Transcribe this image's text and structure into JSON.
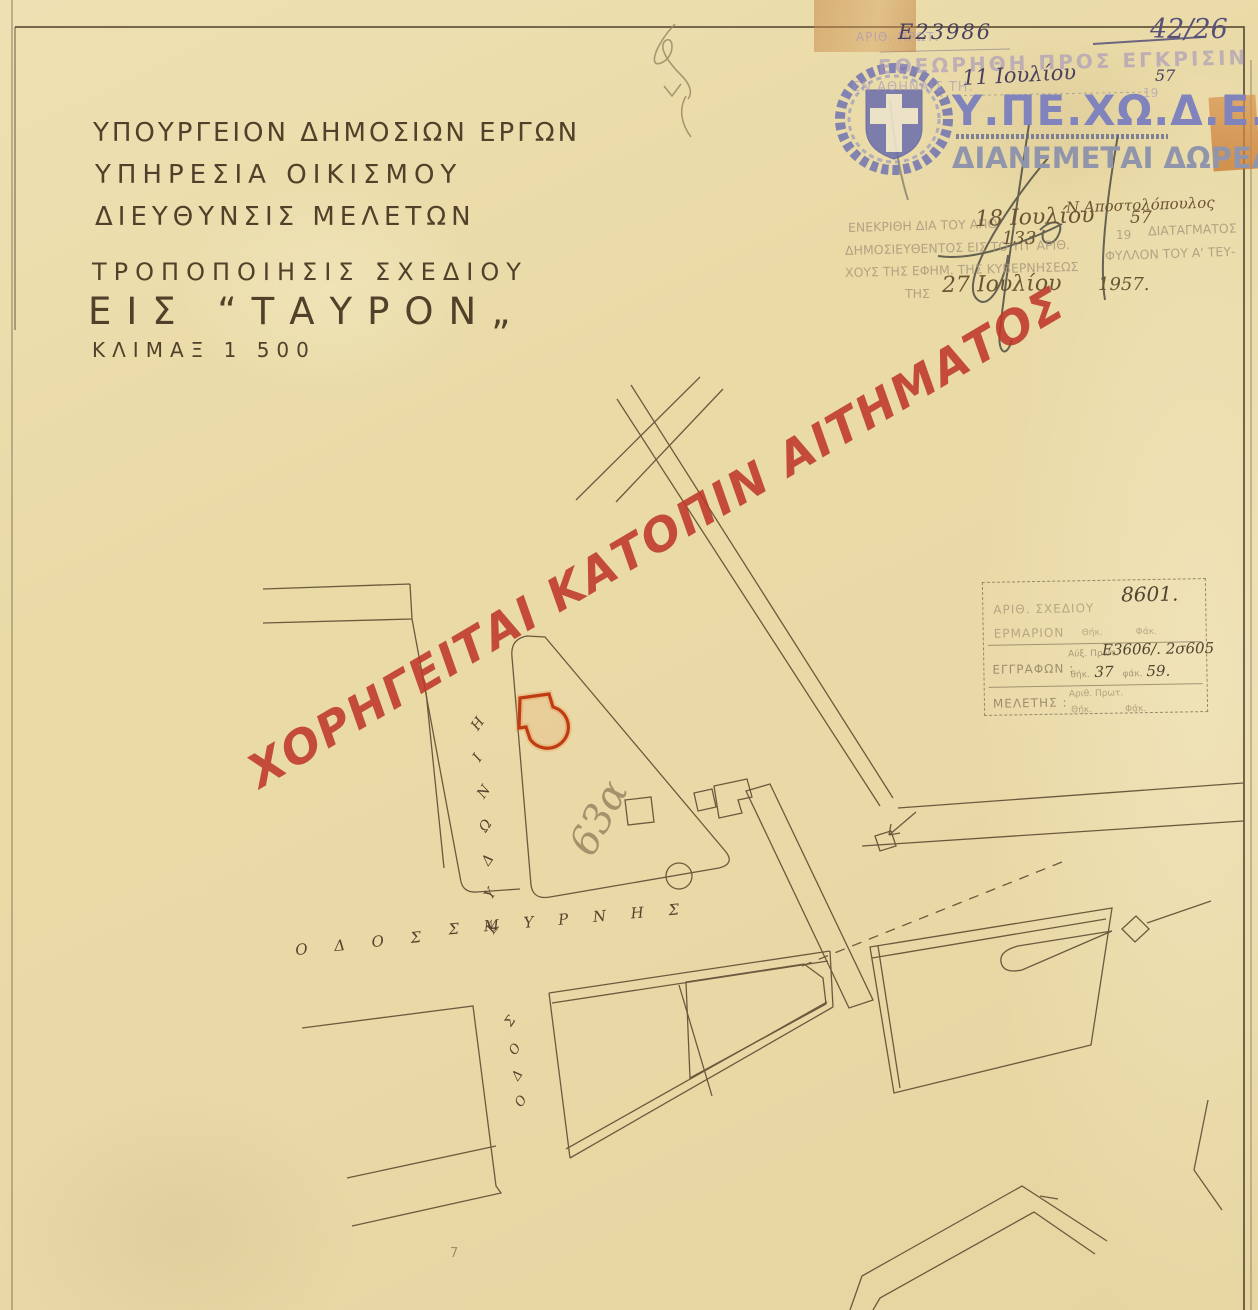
{
  "colors": {
    "paper": "#e9dcab",
    "ink": "#5f4c33",
    "watermark_red": "#c0392b",
    "stamp_blue": "#8184bc",
    "highlight_red": "#c03a12"
  },
  "meta": {
    "sheet_number": "42/26",
    "protocol_label": "ΑΡΙΘ. ΠΡΩΤ.",
    "protocol_number": "Ε23986"
  },
  "title_block": {
    "line1": "ΥΠΟΥΡΓΕΙΟΝ ΔΗΜΟΣΙΩΝ ΕΡΓΩΝ",
    "line2": "ΥΠΗΡΕΣΙΑ ΟΙΚΙΣΜΟΥ",
    "line3": "ΔΙΕΥΘΥΝΣΙΣ ΜΕΛΕΤΩΝ",
    "subject1": "ΤΡΟΠΟΠΟΙΗΣΙΣ ΣΧΕΔΙΟΥ",
    "subject2": "ΕΙΣ “ΤΑΥΡΟΝ„",
    "scale": "ΚΛΙΜΑΞ 1 500"
  },
  "review_stamp": {
    "line1": "ΕΘΕΩΡΗΘΗ ΠΡΟΣ ΕΓΚΡΙΣΙΝ",
    "line2_prefix": "ΕΝ ΑΘΗΝΑΙΣ ΤΗ.",
    "date_hand": "11 Ιουλίου",
    "year_print": "19",
    "year_hand": "57"
  },
  "agency": {
    "acronym": "Υ.ΠΕ.ΧΩ.Δ.Ε.",
    "free_label": "ΔΙΑΝΕΜΕΤΑΙ ΔΩΡΕΑΝ"
  },
  "approval_stamp": {
    "signer": "Ν.Αποστολόπουλος",
    "l1a": "ΕΝΕΚΡΙΘΗ ΔΙΑ ΤΟΥ ΑΠΟ",
    "l1_date": "18 Ιουλίου",
    "l1_year_print": "19",
    "l1_year": "57",
    "l1b": "ΔΙΑΤΑΓΜΑΤΟΣ",
    "l2a": "ΔΗΜΟΣΙΕΥΘΕΝΤΟΣ ΕΙΣ ΤΟ ΥΠ' ΑΡΙΘ.",
    "l2_num": "133",
    "l2b": "ΦΥΛΛΟΝ ΤΟΥ Α' ΤΕΥ-",
    "l3": "ΧΟΥΣ ΤΗΣ ΕΦΗΜ. ΤΗΣ ΚΥΒΕΡΝΗΣΕΩΣ",
    "l4a": "ΤΗΣ",
    "l4_date": "27 Ιουλίου",
    "l4_year": "1957."
  },
  "archive_box": {
    "r1_label": "ΑΡΙΘ. ΣΧΕΔΙΟΥ",
    "r1_value": "8601.",
    "r2_label": "ΕΡΜΑΡΙΟΝ",
    "thik": "Θήκ.",
    "fak": "Φάκ.",
    "r3_label": "ΕΓΓΡΑΦΩΝ :",
    "r3_sub": "Αύξ. Πρωτ.",
    "r3_value": "Ε3606/. 2σ605",
    "r3_thik_label": "θήκ.",
    "r3_thik_value": "37",
    "r3_fak_label": "φάκ.",
    "r3_fak_value": "59.",
    "r4_label": "ΜΕΛΕΤΗΣ :",
    "r4_sub": "Αριθ. Πρωτ."
  },
  "watermark": {
    "text": "ΧΟΡΗΓΕΙΤΑΙ ΚΑΤΟΠΙΝ ΑΙΤΗΜΑΤΟΣ"
  },
  "plan": {
    "street_main_a": "Ο Δ Ο Σ",
    "street_main_b": "Σ Μ Υ Ρ Ν Η Σ",
    "street_side_letters": [
      "Η",
      "Ι",
      "Ν",
      "Ω",
      "Δ",
      "Υ",
      "Κ"
    ],
    "street_south_letters": [
      "Σ",
      "Ο",
      "Δ",
      "Ο"
    ],
    "parcel_note": "63α",
    "pencil_note": "7"
  }
}
